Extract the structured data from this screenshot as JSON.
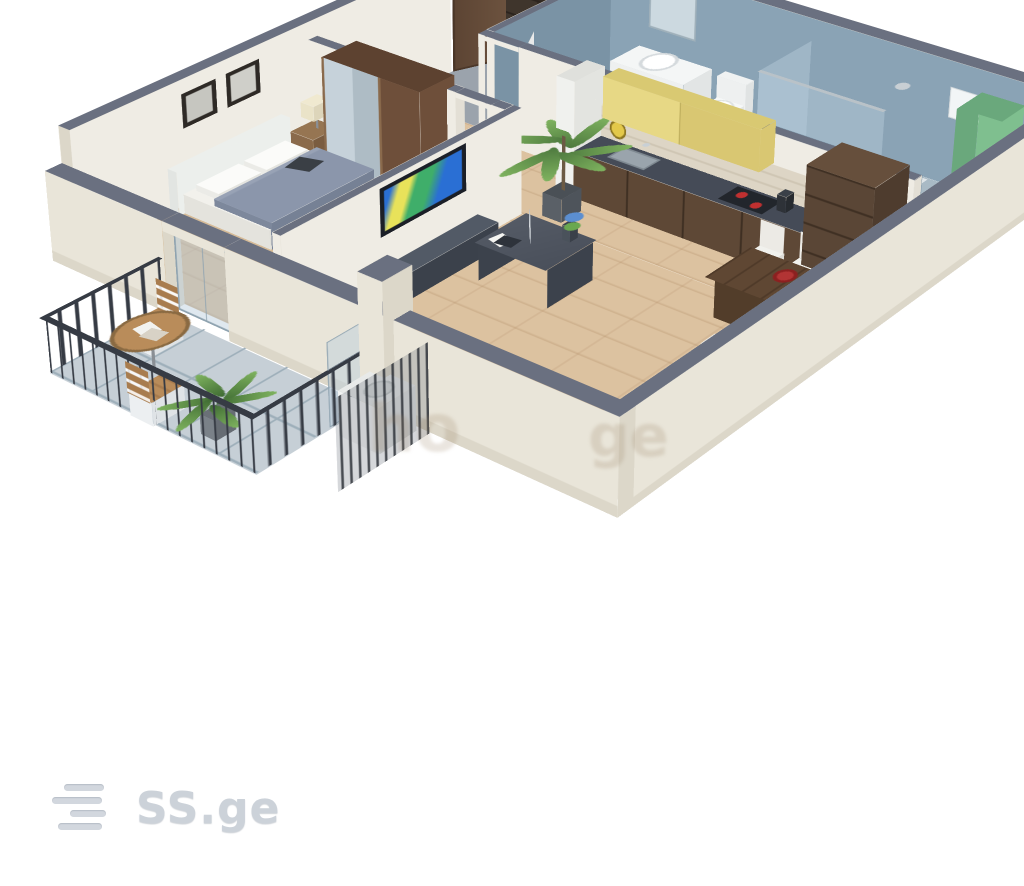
{
  "branding": {
    "logo_text": "SS.ge",
    "logo_icon": "stacked-lines-icon",
    "logo_color": "#ccd2d9"
  },
  "watermark": {
    "fragment_1": "ho",
    "fragment_2": "ge",
    "color": "rgba(150,125,95,0.20)"
  },
  "scene": {
    "type": "3d-isometric-floorplan",
    "rooms": [
      "bedroom",
      "entry-hall",
      "bathroom",
      "kitchen",
      "living-room",
      "balcony"
    ]
  },
  "palette": {
    "wallTop": "#6a7080",
    "extWall": "#e9e5d9",
    "extWallShade": "#dcd7c9",
    "intWall": "#efece4",
    "intWallDim": "#e3dfd5",
    "bathWall": "#8aa3b5",
    "bathWallDark": "#7a93a5",
    "bathFloor": "#a9bac5",
    "wood": "#dcc2a0",
    "woodBedroom": "#d6bb97",
    "entryFloor": "#9ba3ac",
    "balconyTile": "#c6cfd6",
    "tileLine": "#9eafba",
    "railing": "#363b44",
    "glass": "rgba(185,205,220,0.45)",
    "glassEdge": "#8fa3b0",
    "doorBrown": "#5d4534",
    "wardrobeBrown": "#6e4f3a",
    "wardrobeTop": "#5d4230",
    "mirror": "#c6d2da",
    "entryWardrobe": "#3f352c",
    "entryWardrobeDark": "#2b231d",
    "bedFrame": "#f2f1ec",
    "blanket": "#8b96ab",
    "pillow": "#fbfbf9",
    "headboard": "#ecefec",
    "nightstand": "#8a6a4b",
    "lampShade": "#eae3c8",
    "armchair": "#c6c96d",
    "armchairDark": "#b5ba5c",
    "cabinetYellow": "#e7d885",
    "cabinetYellowDark": "#d9c772",
    "counterTop": "#454b57",
    "counterFront": "#5e4836",
    "counterSide": "#4f3c2d",
    "backsplash": "#ddd5c5",
    "sinkSilver": "#9aa4ac",
    "cooktop": "#22262c",
    "burnerRed": "#c03030",
    "plateRed": "#b23434",
    "chairWhite": "#f1f1ed",
    "tableWood": "#5f4733",
    "tableWoodDark": "#523d2a",
    "sofa": "#f1efe8",
    "sofaShade": "#e6e3d9",
    "pillowGreen": "#8cc04e",
    "teal": "#38a39a",
    "orange": "#df8c3c",
    "tvFrame": "#1b1f27",
    "tvStand": "#464d58",
    "tvStandTop": "#525a66",
    "tvScreenA": "#2a6fd4",
    "tvScreenB": "#3fae6a",
    "tvScreenC": "#e8e25a",
    "plantGreen": "#4e7a3f",
    "plantLight": "#7fb35f",
    "potDark": "#5a6067",
    "nicheGreen": "#7fbf8f",
    "nicheGreenDark": "#6aa87c",
    "acWhite": "#f4f5f4",
    "vanityWhite": "#eef0f0",
    "clockYellow": "#e3c84a",
    "woodTable": "#b98c5a",
    "woodTableEdge": "#8a6a42",
    "logoGray": "#cdd3da"
  }
}
